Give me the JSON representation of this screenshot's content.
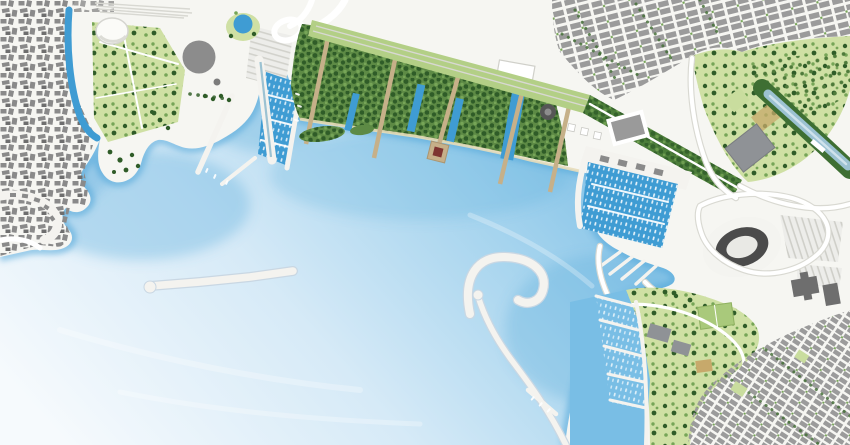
{
  "map": {
    "kind": "waterfront-masterplan-render",
    "view": "aerial-plan",
    "features": [
      "old-town-district",
      "old-town-canal",
      "west-park",
      "esplanade",
      "circular-building",
      "pond",
      "parking-stripes",
      "northwest-marina-basin",
      "harbor-piers",
      "breakwater-island",
      "green-islands",
      "central-forest-park",
      "timber-piers",
      "pier-platform",
      "park-canals",
      "rail-lawn-corridor",
      "green-boulevard",
      "northeast-city-grid",
      "northeast-park",
      "linear-teal-building",
      "large-gray-building",
      "east-marina-basin",
      "marina-boats",
      "stadium",
      "stadium-parking",
      "ring-roads",
      "highway-interchange",
      "south-headland-park",
      "sports-fields",
      "industrial-buildings",
      "southeast-city-grid",
      "south-marina-piers",
      "hook-breakwater",
      "long-breakwater",
      "harbor-bay-water"
    ]
  },
  "colors": {
    "water_light": "#f6fafd",
    "water_mid": "#d6eaf7",
    "water_deep": "#a6d4ee",
    "water_shore": "#7fc0e6",
    "depth_blue": "#58abdc",
    "harbor_blue": "#3f9cd3",
    "land": "#f6f6f2",
    "road_white": "#ffffff",
    "road_casing": "#d9d9d2",
    "oldtown_gray": "#8a8a8a",
    "block_gray": "#9b9b9b",
    "building_dark": "#6e6e6e",
    "steel_gray": "#8f9296",
    "circle_building_gray": "#8c8c8c",
    "stadium_ring": "#4b4b4b",
    "forest_green": "#5d8a45",
    "tree_dark": "#2f5c28",
    "tree_light": "#76a557",
    "park_light": "#cfe0a4",
    "lawn_green": "#b3cf86",
    "boulevard_green": "#4c7d3a",
    "orchard_green": "#c9dd9e",
    "field_green": "#a9c97b",
    "court_tan": "#c7a96b",
    "pier_tan": "#c6b089",
    "platform_red": "#7e3430",
    "teal_building": "#9cc2d2",
    "pier_white": "#f4f3ef",
    "sand": "#e8ddba"
  }
}
